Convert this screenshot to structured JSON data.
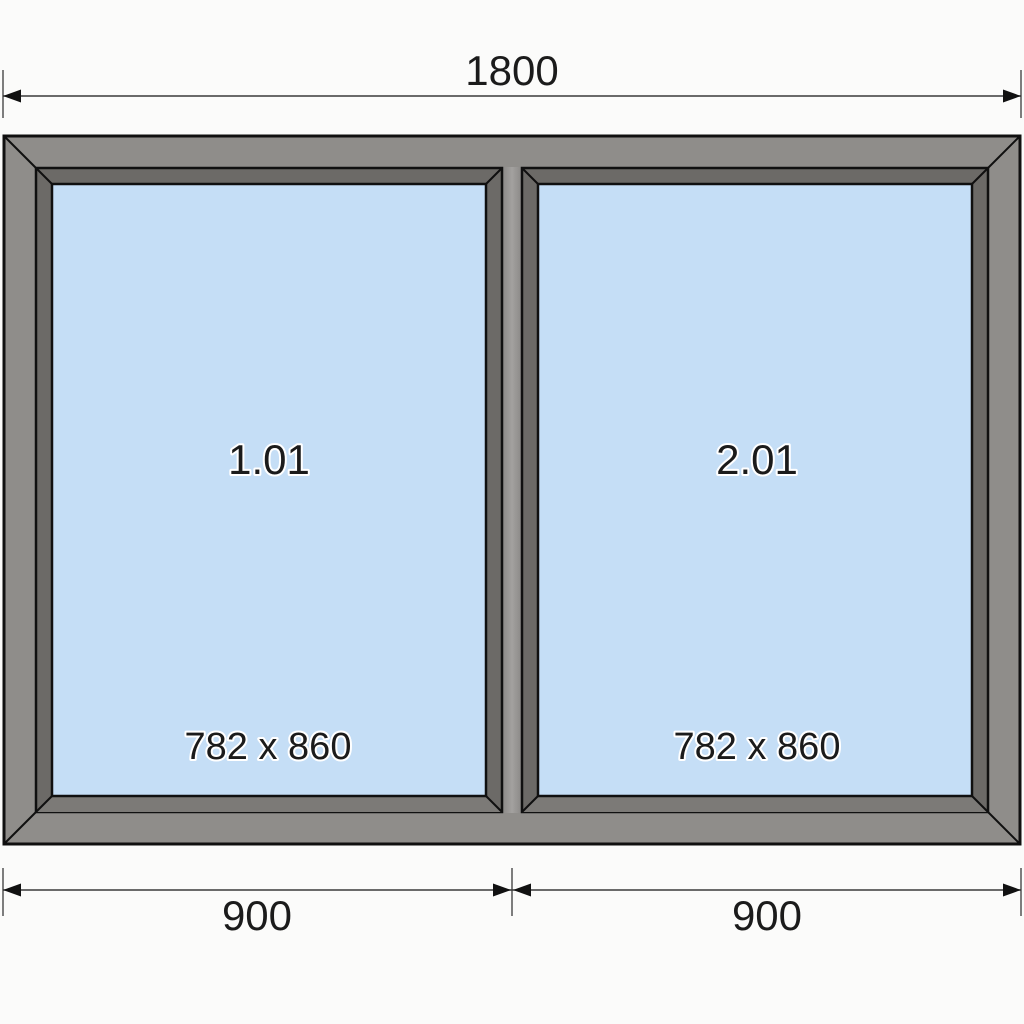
{
  "diagram": {
    "dimensions": {
      "top_width": "1800",
      "bottom_left_width": "900",
      "bottom_right_width": "900"
    },
    "panels": [
      {
        "label": "1.01",
        "glass_size": "782 x 860"
      },
      {
        "label": "2.01",
        "glass_size": "782 x 860"
      }
    ],
    "colors": {
      "background": "#fbfbfa",
      "frame": "#8f8d8a",
      "sash": "#6c6a67",
      "sash_bottom": "#7c7a77",
      "mullion_edge": "#8a8886",
      "mullion_center": "#a3a19f",
      "glass": "#c5def6",
      "outline": "#101010",
      "dimension_line": "#3a3a3a",
      "extension_line": "#7d7d7d",
      "arrow": "#111111",
      "text": "#1b1b1b"
    }
  }
}
